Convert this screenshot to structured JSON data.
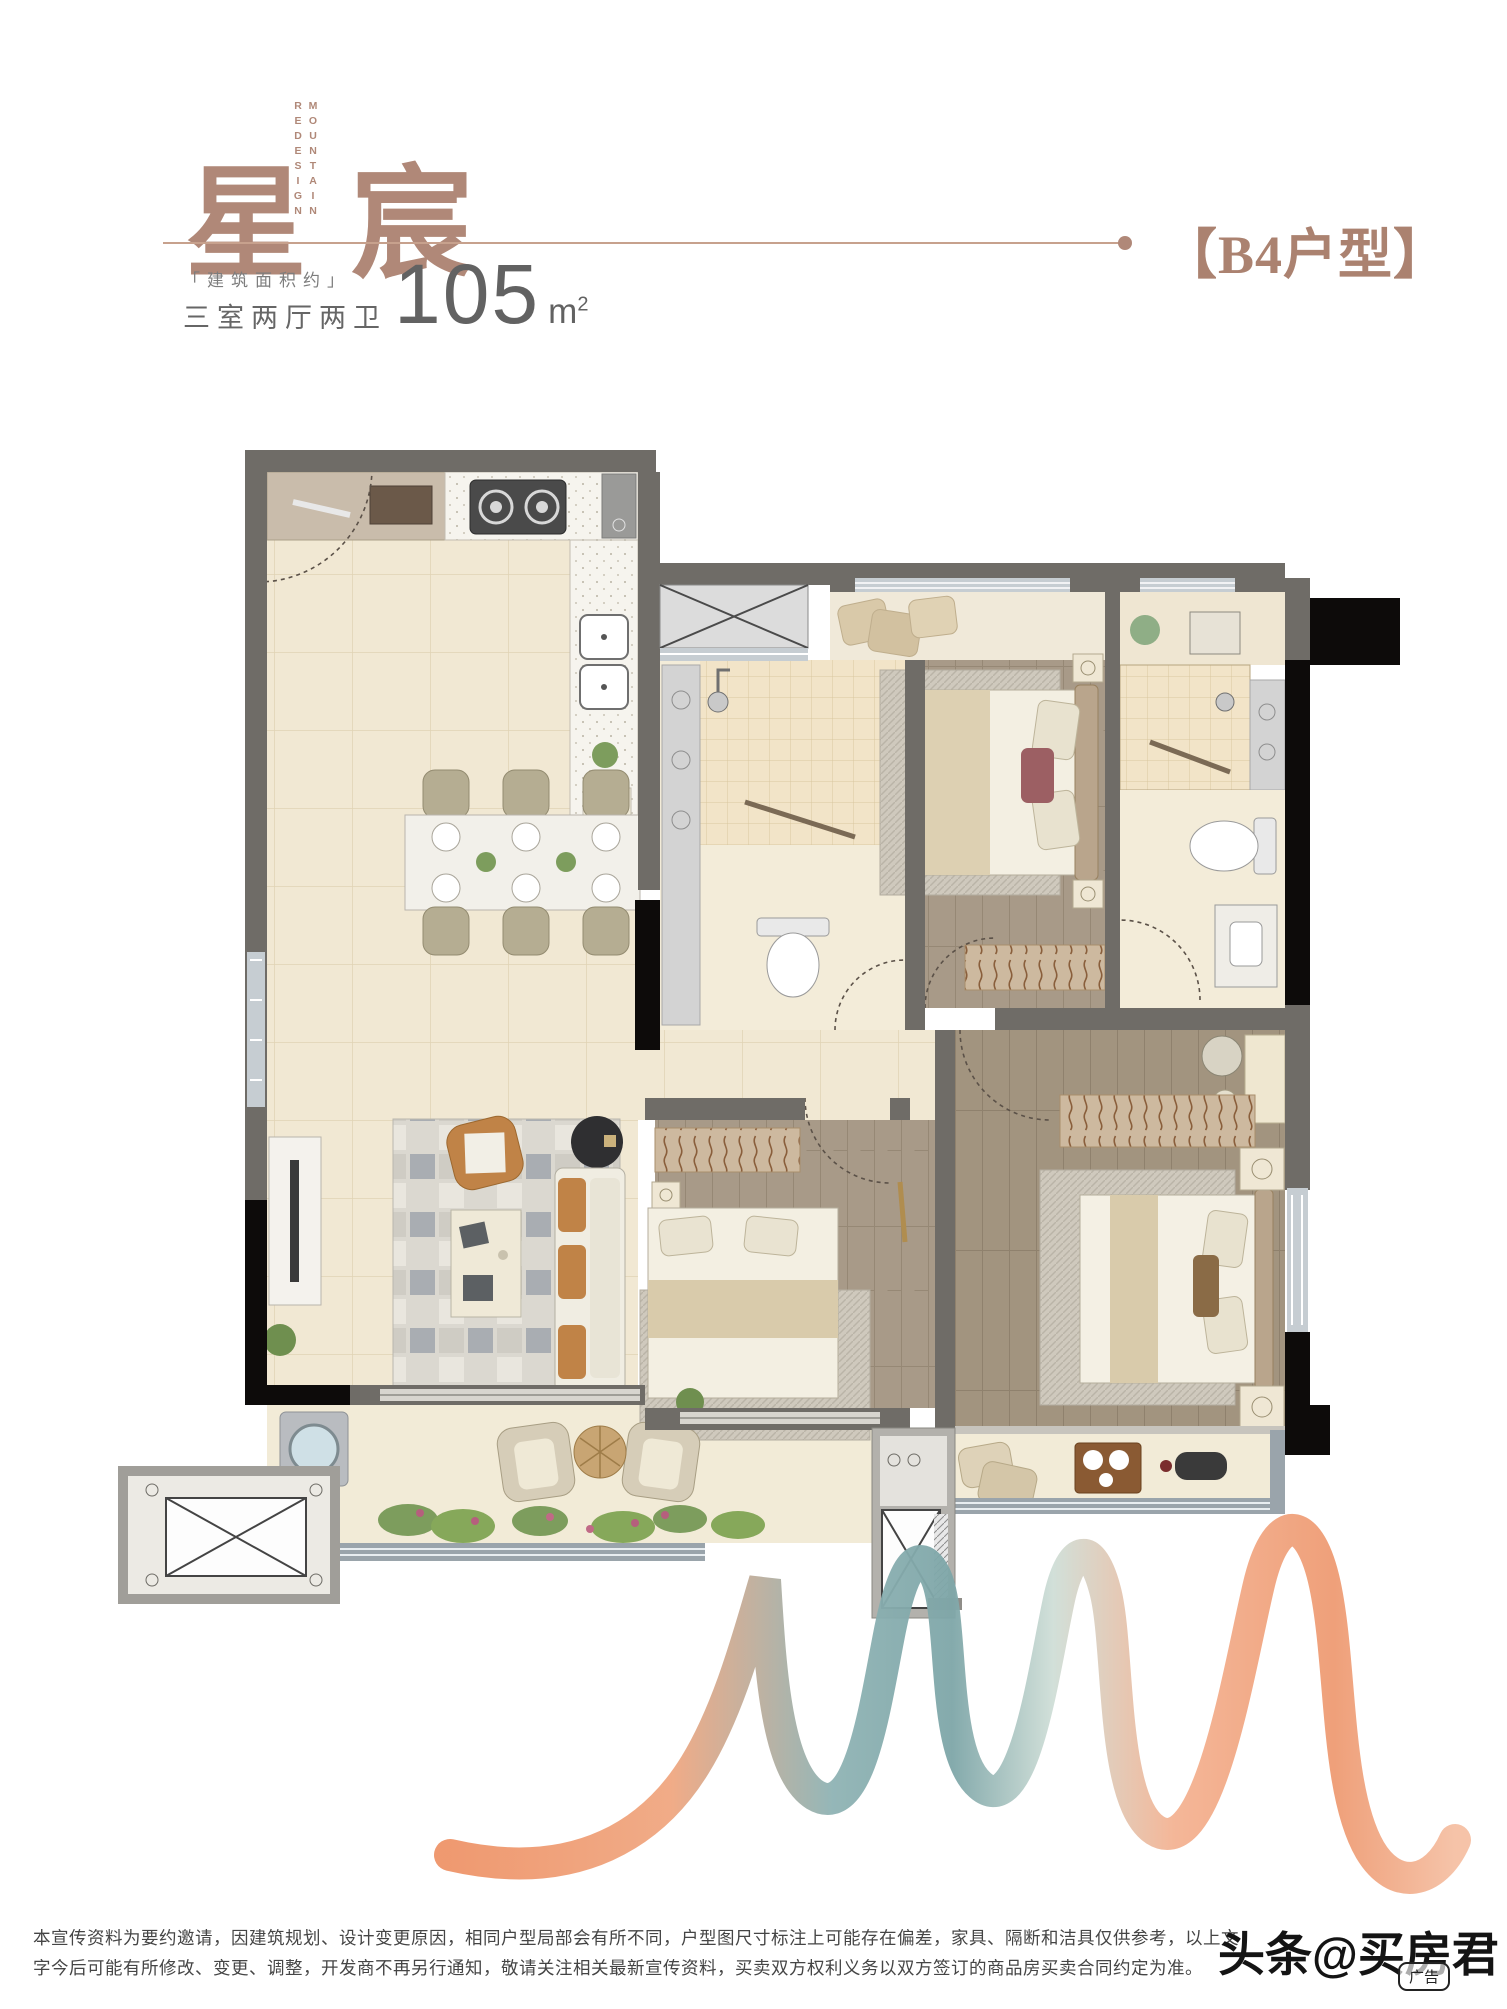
{
  "header": {
    "title": "星宸",
    "title_color": "#b08878",
    "vertical_words": [
      "MOUNTAIN",
      "REDESIGN"
    ],
    "area_label": "「建筑面积约」",
    "layout_label": "三室两厅两卫",
    "area_value": "105",
    "area_unit": "m",
    "area_unit_sup": "2",
    "unit_tag": "【B4户型】",
    "divider_color": "#c7a18d"
  },
  "floor_plan": {
    "wall_color": "#6f6c67",
    "accent_wall_color": "#0d0b0a",
    "tile_floor_color": "#f1e8d3",
    "wood_floor_color": "#a89a88",
    "bath_tile_color": "#f2e4c8",
    "rooms": [
      "entry-foyer",
      "kitchen",
      "dining-area",
      "living-room",
      "shower-bathroom",
      "bedroom-secondary",
      "master-bathroom",
      "bedroom-middle",
      "master-bedroom",
      "living-balcony",
      "master-balcony",
      "elevator-lobby",
      "elevator-shaft"
    ]
  },
  "ribbon": {
    "colors": [
      "#ee9469",
      "#8fb3b4",
      "#f2b197"
    ]
  },
  "footer": {
    "disclaimer_line1": "本宣传资料为要约邀请，因建筑规划、设计变更原因，相同户型局部会有所不同，户型图尺寸标注上可能存在偏差，家具、隔断和洁具仅供参考，以上文",
    "disclaimer_line2": "字今后可能有所修改、变更、调整，开发商不再另行通知，敬请关注相关最新宣传资料，买卖双方权利义务以双方签订的商品房买卖合同约定为准。",
    "watermark": "头条@买房君",
    "ad_badge": "广告"
  }
}
